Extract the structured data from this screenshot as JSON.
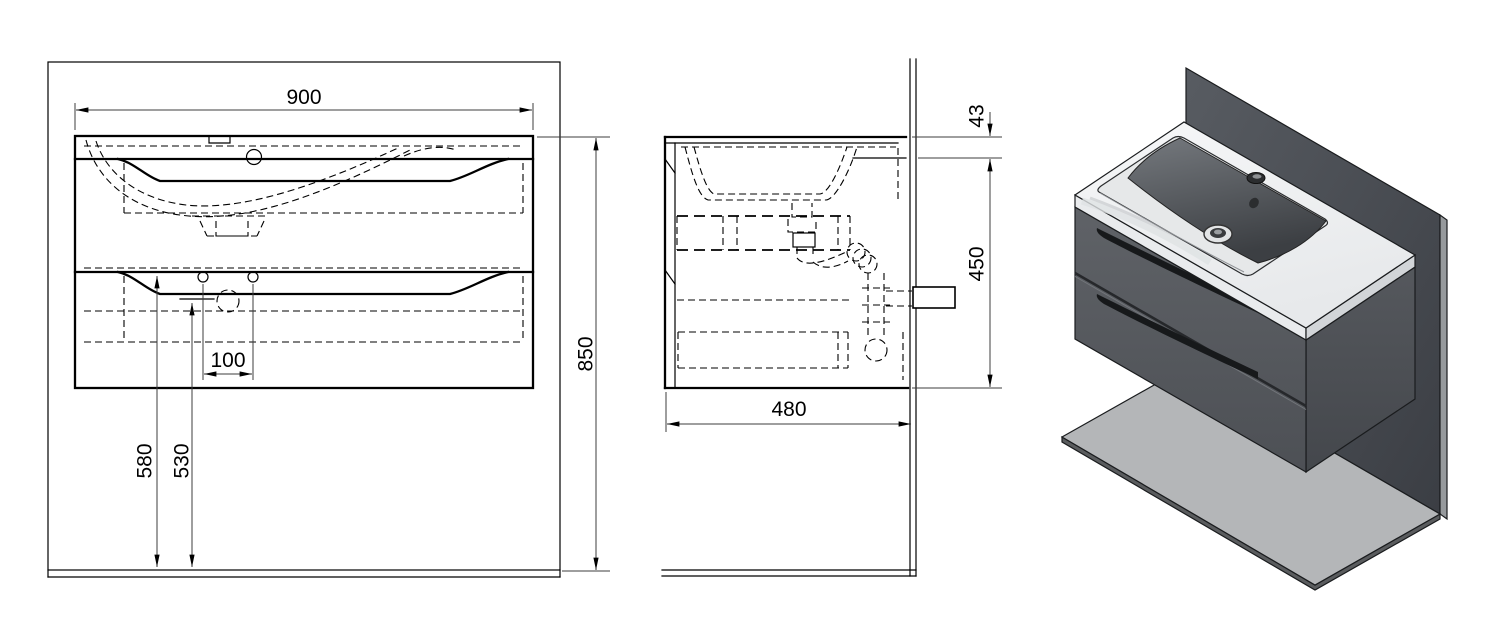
{
  "dimensions_mm": {
    "cabinet_width": "900",
    "total_height": "850",
    "drain_offset": "100",
    "height_to_drawer_top": "580",
    "height_to_drain": "530",
    "basin_height": "43",
    "cabinet_body_height": "450",
    "cabinet_depth": "480"
  },
  "colors": {
    "drawing_line": "#000000",
    "background": "#ffffff",
    "cabinet_render": "#56595e",
    "wall_panel_render": "#4a4e54",
    "floor_panel_render": "#b4b6b8",
    "washbasin_render": "#f3f4f5"
  }
}
